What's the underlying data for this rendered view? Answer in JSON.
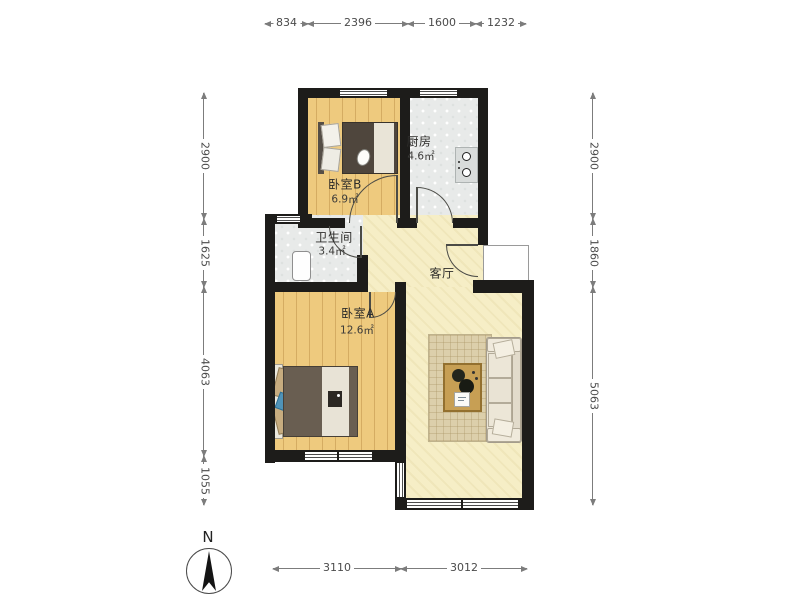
{
  "rooms": {
    "bedroom_b": {
      "name": "卧室B",
      "area": "6.9㎡"
    },
    "kitchen": {
      "name": "厨房",
      "area": "4.6㎡"
    },
    "bathroom": {
      "name": "卫生间",
      "area": "3.4㎡"
    },
    "bedroom_a": {
      "name": "卧室A",
      "area": "12.6㎡"
    },
    "living_room": {
      "name": "客厅"
    }
  },
  "dimensions_mm": {
    "top": [
      "834",
      "2396",
      "1600",
      "1232"
    ],
    "left": [
      "2900",
      "1625",
      "4063",
      "1055"
    ],
    "right": [
      "2900",
      "1860",
      "5063"
    ],
    "bottom": [
      "3110",
      "3012"
    ]
  },
  "compass": {
    "north_label": "N"
  },
  "colors": {
    "wall": "#1d1c1a",
    "wood_floor": "#eeca7e",
    "tile_floor": "#e8eae9",
    "living_floor": "#f6eec6",
    "dimension_line": "#7c7c7c"
  }
}
